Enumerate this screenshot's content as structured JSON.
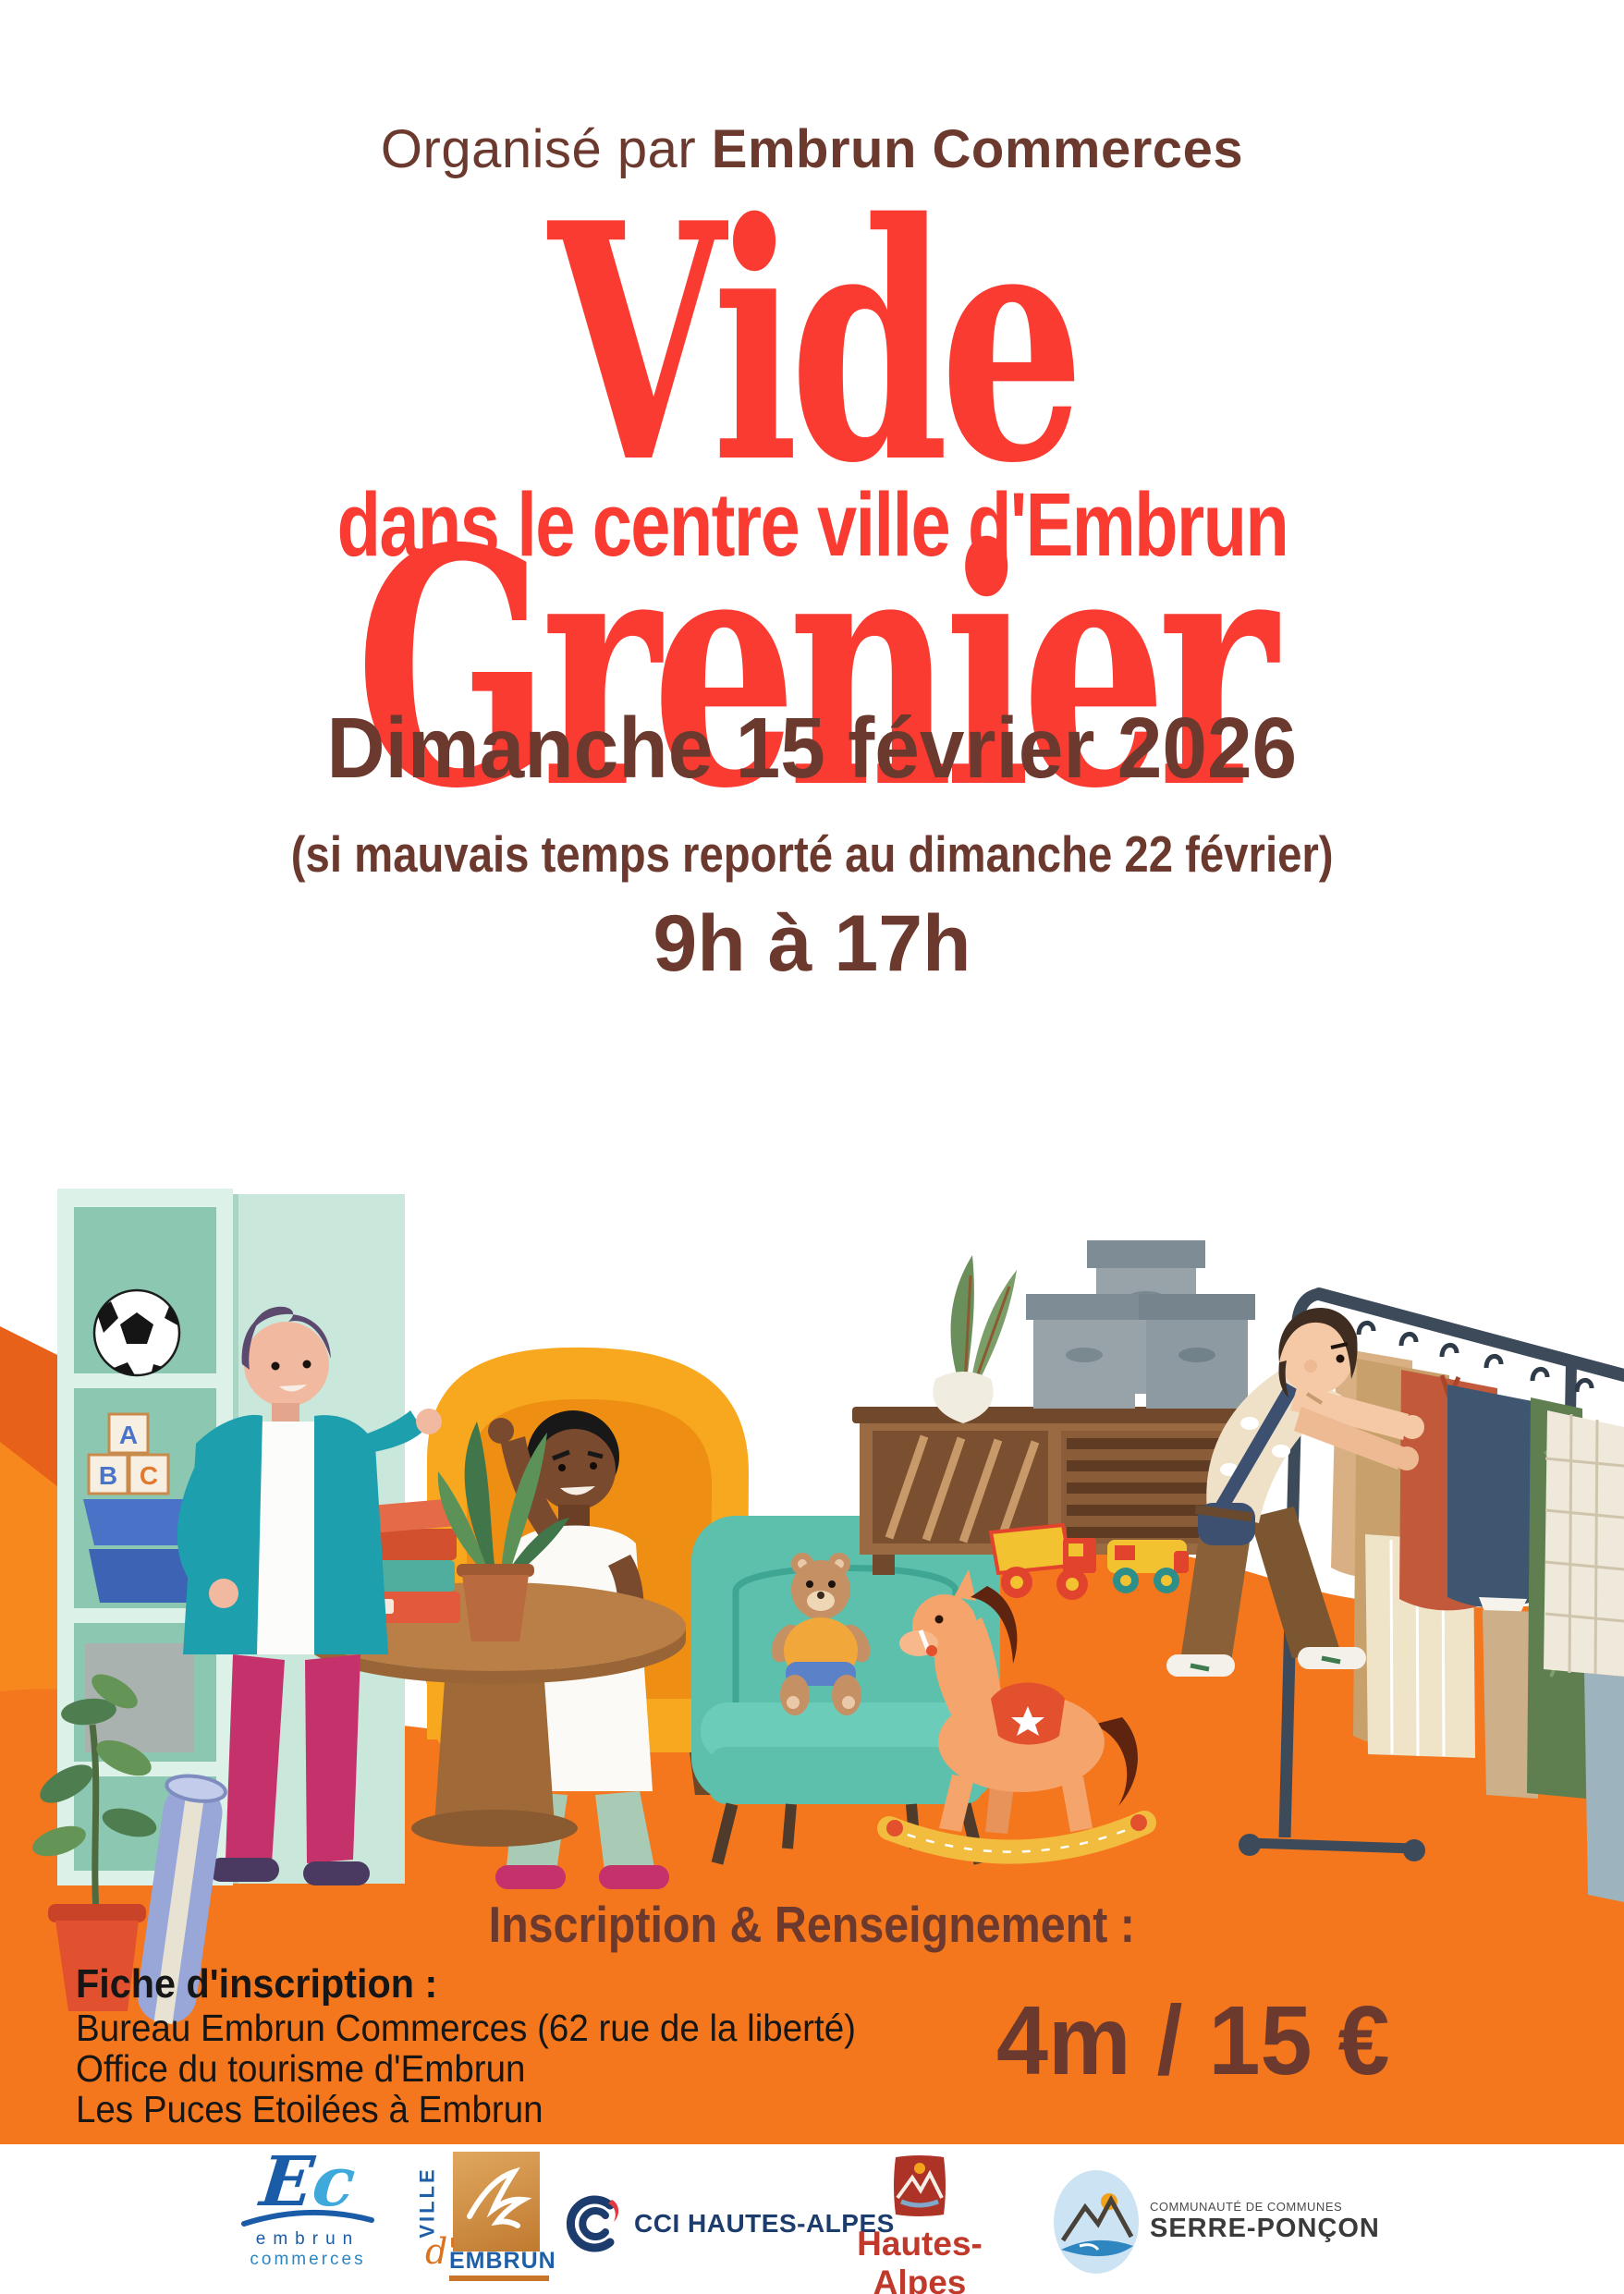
{
  "poster": {
    "organizer": {
      "prefix": "Organisé par ",
      "name": "Embrun Commerces"
    },
    "title": "Vide Grenier",
    "subtitle": "dans le centre ville d'Embrun",
    "date": "Dimanche 15 février 2026",
    "weather_note": "(si mauvais temps reporté au dimanche 22 février)",
    "hours": "9h à 17h",
    "info_heading": "Inscription & Renseignement :",
    "registration": {
      "heading": "Fiche d'inscription :",
      "lines": [
        "Bureau Embrun Commerces (62 rue de la liberté)",
        "Office du tourisme d'Embrun",
        "Les Puces Etoilées à Embrun"
      ]
    },
    "price": "4m / 15 €",
    "colors": {
      "title_red": "#F93B32",
      "text_brown": "#6C392E",
      "band_orange": "#F4771E",
      "text_black": "#161616"
    }
  },
  "illustration": {
    "blocks": {
      "a": "A",
      "b": "B",
      "c": "C"
    }
  },
  "logos": {
    "embrun_commerces": {
      "monogram_e": "E",
      "monogram_c": "c",
      "line1": "embrun",
      "line2": "commerces"
    },
    "ville_embrun": {
      "vertical": "VILLE",
      "apostrophe": "d'",
      "name": "EMBRUN"
    },
    "cci": {
      "label": "CCI HAUTES-ALPES"
    },
    "hautes_alpes": {
      "name": "Hautes-Alpes",
      "tagline": "le département"
    },
    "serre_poncon": {
      "line1": "COMMUNAUTÉ DE COMMUNES",
      "line2": "SERRE-PONÇON"
    }
  }
}
